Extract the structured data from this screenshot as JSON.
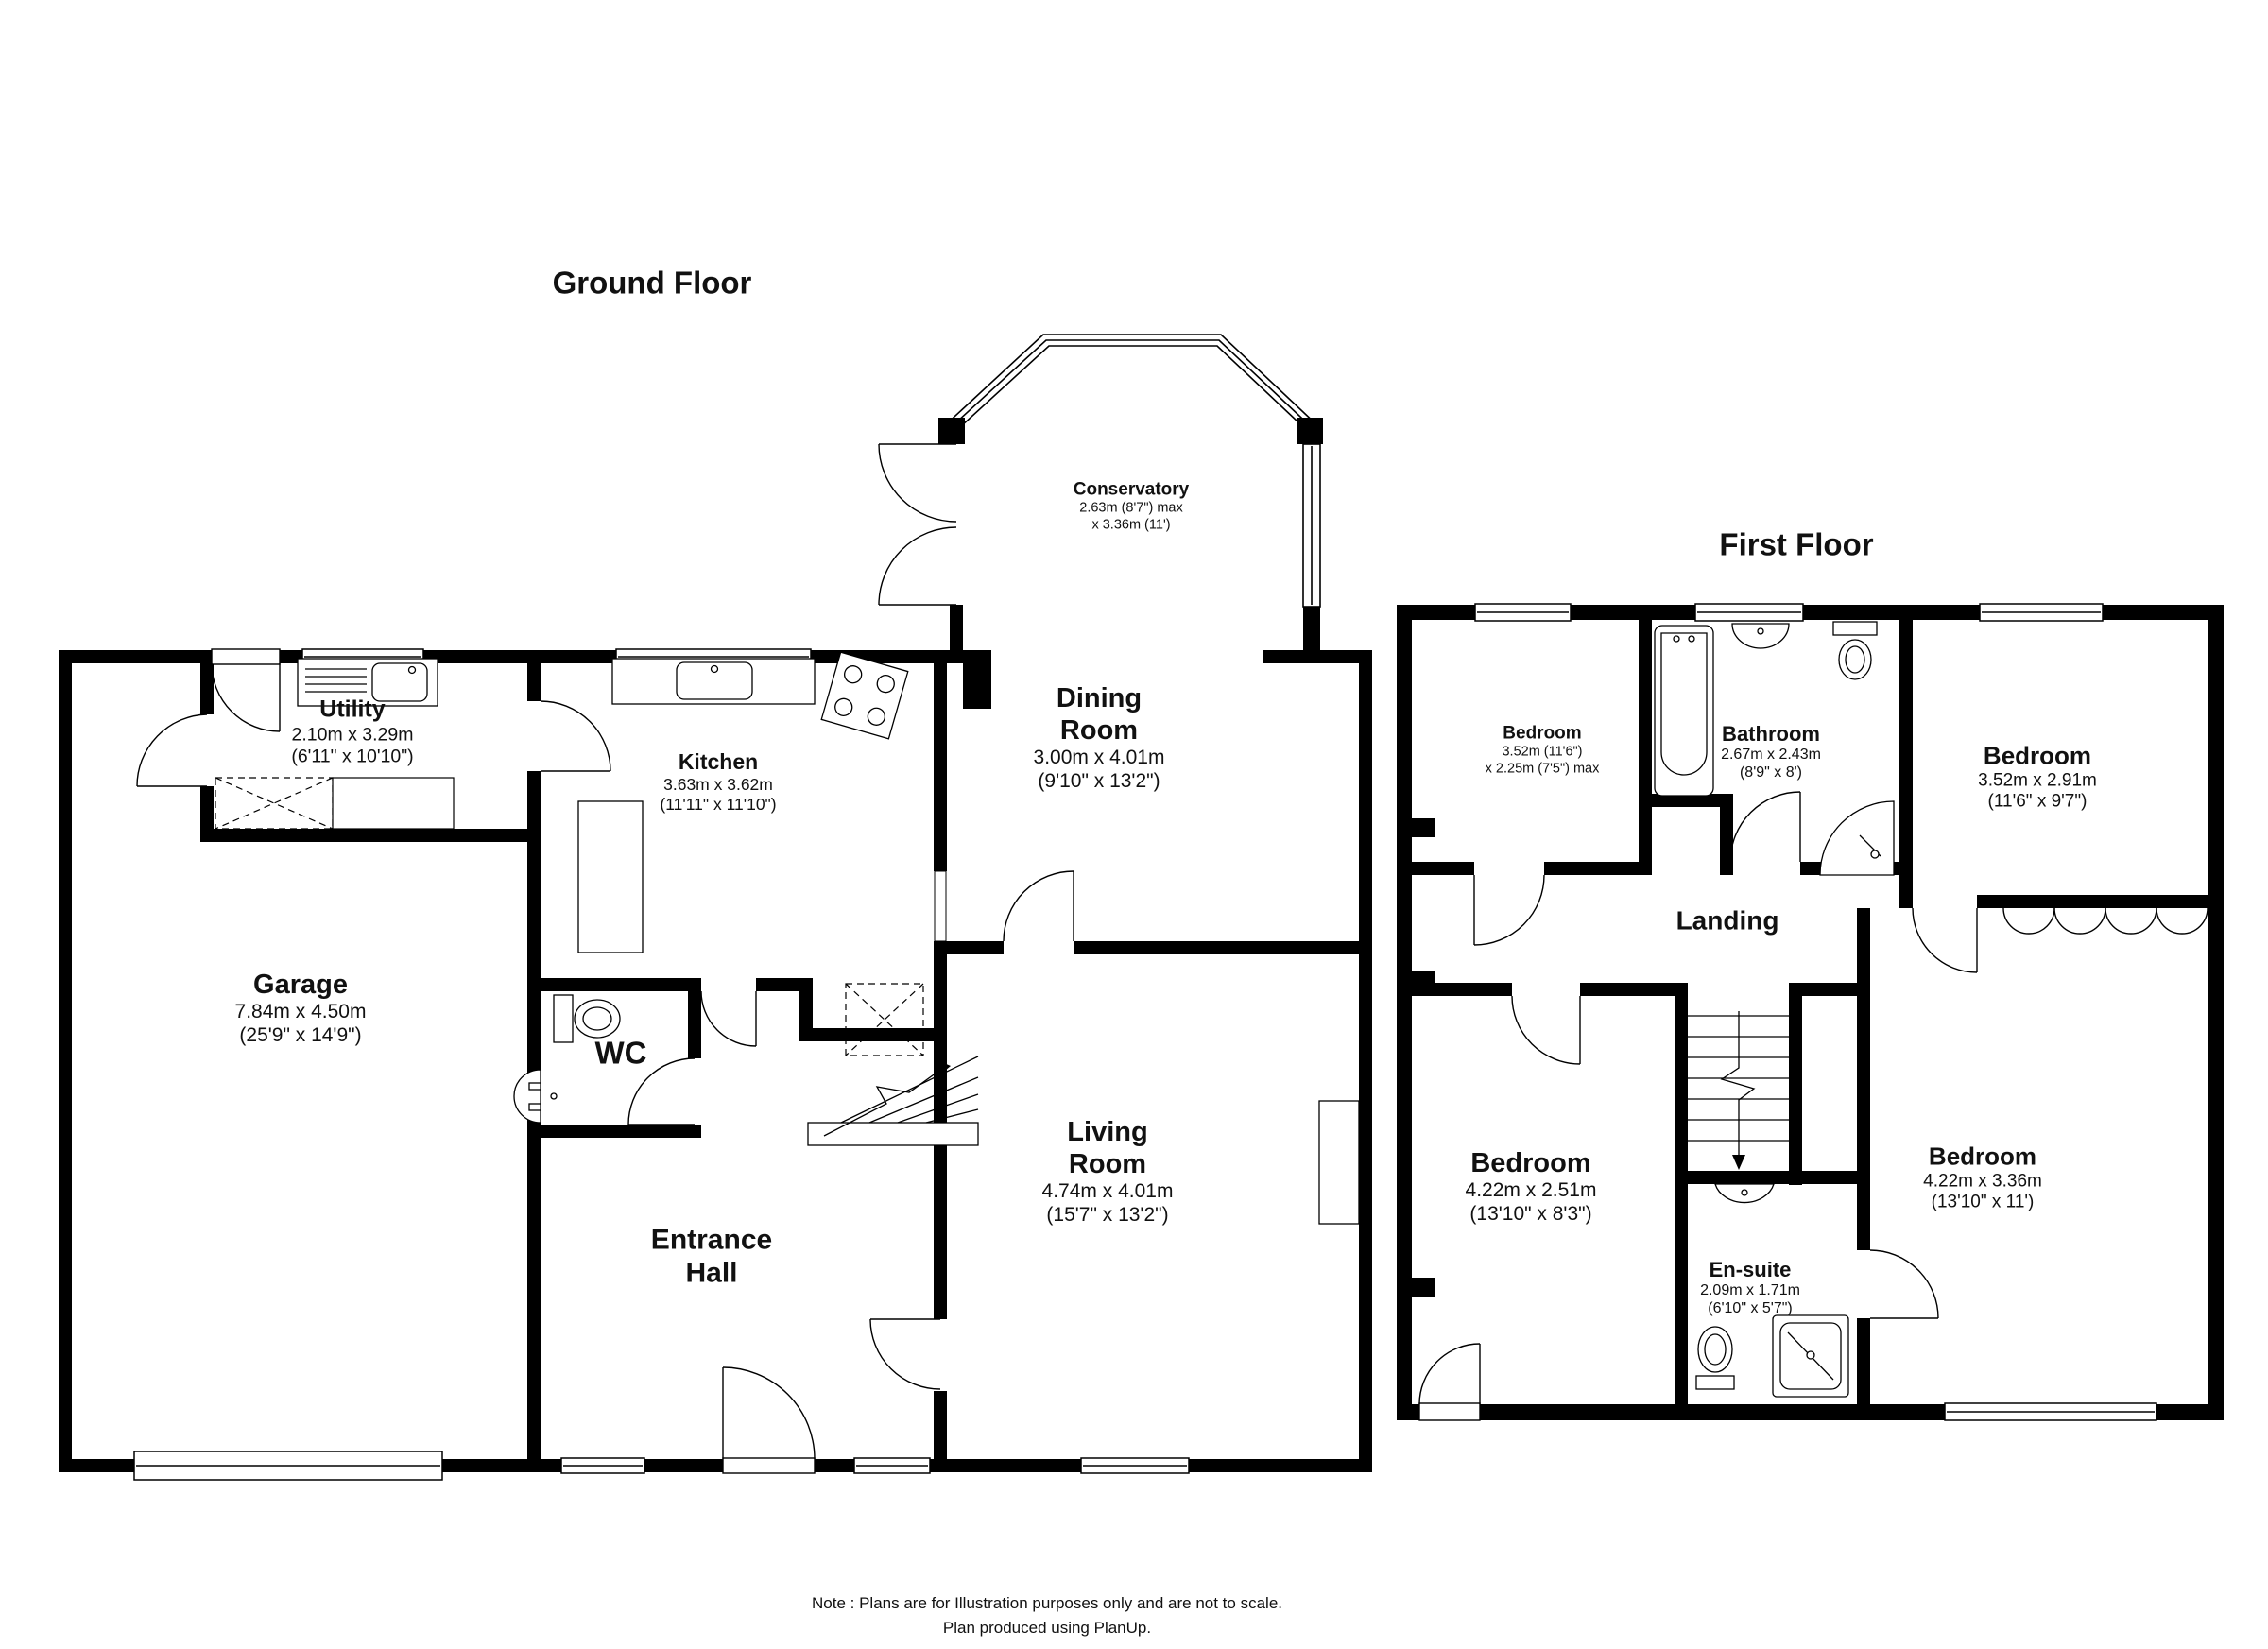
{
  "titles": {
    "ground_floor": "Ground Floor",
    "first_floor": "First Floor"
  },
  "note": {
    "line1": "Note : Plans are for Illustration purposes only and are not to scale.",
    "line2": "Plan produced using PlanUp."
  },
  "ground_floor": {
    "conservatory": {
      "name": "Conservatory",
      "dim1": "2.63m (8'7\") max",
      "dim2": "x 3.36m (11')"
    },
    "utility": {
      "name": "Utility",
      "dim1": "2.10m x 3.29m",
      "dim2": "(6'11\" x 10'10\")"
    },
    "kitchen": {
      "name": "Kitchen",
      "dim1": "3.63m x 3.62m",
      "dim2": "(11'11\" x 11'10\")"
    },
    "dining_room": {
      "name1": "Dining",
      "name2": "Room",
      "dim1": "3.00m x 4.01m",
      "dim2": "(9'10\" x 13'2\")"
    },
    "garage": {
      "name": "Garage",
      "dim1": "7.84m x 4.50m",
      "dim2": "(25'9\" x 14'9\")"
    },
    "wc": {
      "name": "WC"
    },
    "living_room": {
      "name1": "Living",
      "name2": "Room",
      "dim1": "4.74m x 4.01m",
      "dim2": "(15'7\" x 13'2\")"
    },
    "entrance_hall": {
      "name1": "Entrance",
      "name2": "Hall"
    }
  },
  "first_floor": {
    "bedroom_top_left": {
      "name": "Bedroom",
      "dim1": "3.52m (11'6\")",
      "dim2": "x 2.25m (7'5\") max"
    },
    "bathroom": {
      "name": "Bathroom",
      "dim1": "2.67m x 2.43m",
      "dim2": "(8'9\" x 8')"
    },
    "bedroom_top_right": {
      "name": "Bedroom",
      "dim1": "3.52m x 2.91m",
      "dim2": "(11'6\" x 9'7\")"
    },
    "landing": {
      "name": "Landing"
    },
    "bedroom_bottom_left": {
      "name": "Bedroom",
      "dim1": "4.22m x 2.51m",
      "dim2": "(13'10\" x 8'3\")"
    },
    "ensuite": {
      "name": "En-suite",
      "dim1": "2.09m x 1.71m",
      "dim2": "(6'10\" x 5'7\")"
    },
    "bedroom_bottom_right": {
      "name": "Bedroom",
      "dim1": "4.22m x 3.36m",
      "dim2": "(13'10\" x 11')"
    }
  }
}
